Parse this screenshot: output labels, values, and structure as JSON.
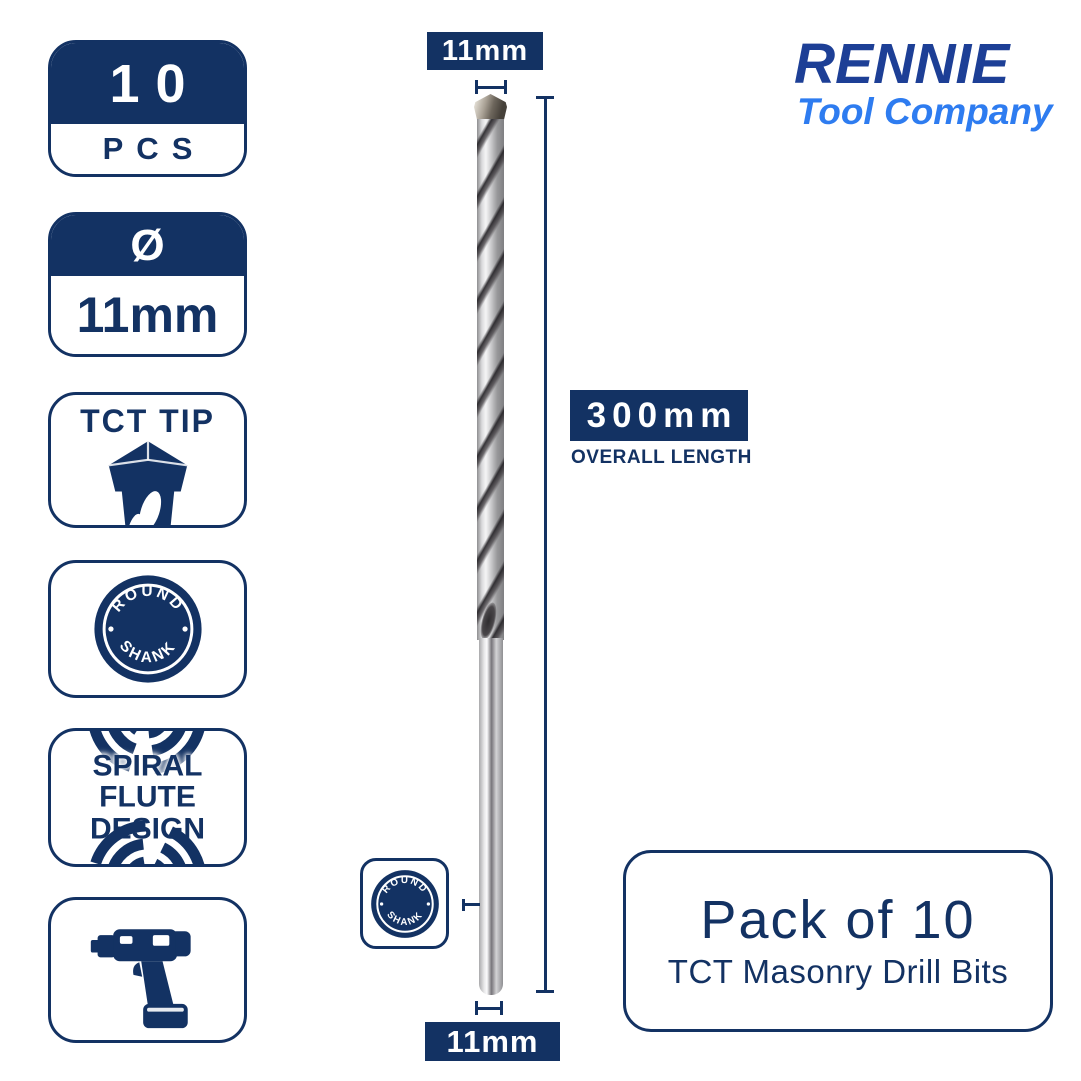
{
  "colors": {
    "navy": "#133263",
    "brand_dark": "#1d3f96",
    "brand_light": "#2e7cf0"
  },
  "brand": {
    "name": "RENNIE",
    "tagline": "Tool Company"
  },
  "badges": {
    "pcs": {
      "value": "10",
      "unit": "PCS"
    },
    "diameter": {
      "symbol": "Ø",
      "value": "11mm"
    },
    "tct_tip": {
      "label": "TCT TIP"
    },
    "round_shank": {
      "word_top": "ROUND",
      "word_bottom": "SHANK"
    },
    "spiral_flute": {
      "line1": "SPIRAL FLUTE",
      "line2": "DESIGN"
    }
  },
  "dimensions": {
    "tip_diameter": "11mm",
    "overall_length": {
      "value": "300mm",
      "label": "OVERALL LENGTH"
    },
    "shank_diameter": "11mm"
  },
  "shank_stamp": {
    "word_top": "ROUND",
    "word_bottom": "SHANK"
  },
  "pack": {
    "title": "Pack of 10",
    "subtitle": "TCT Masonry Drill Bits"
  }
}
